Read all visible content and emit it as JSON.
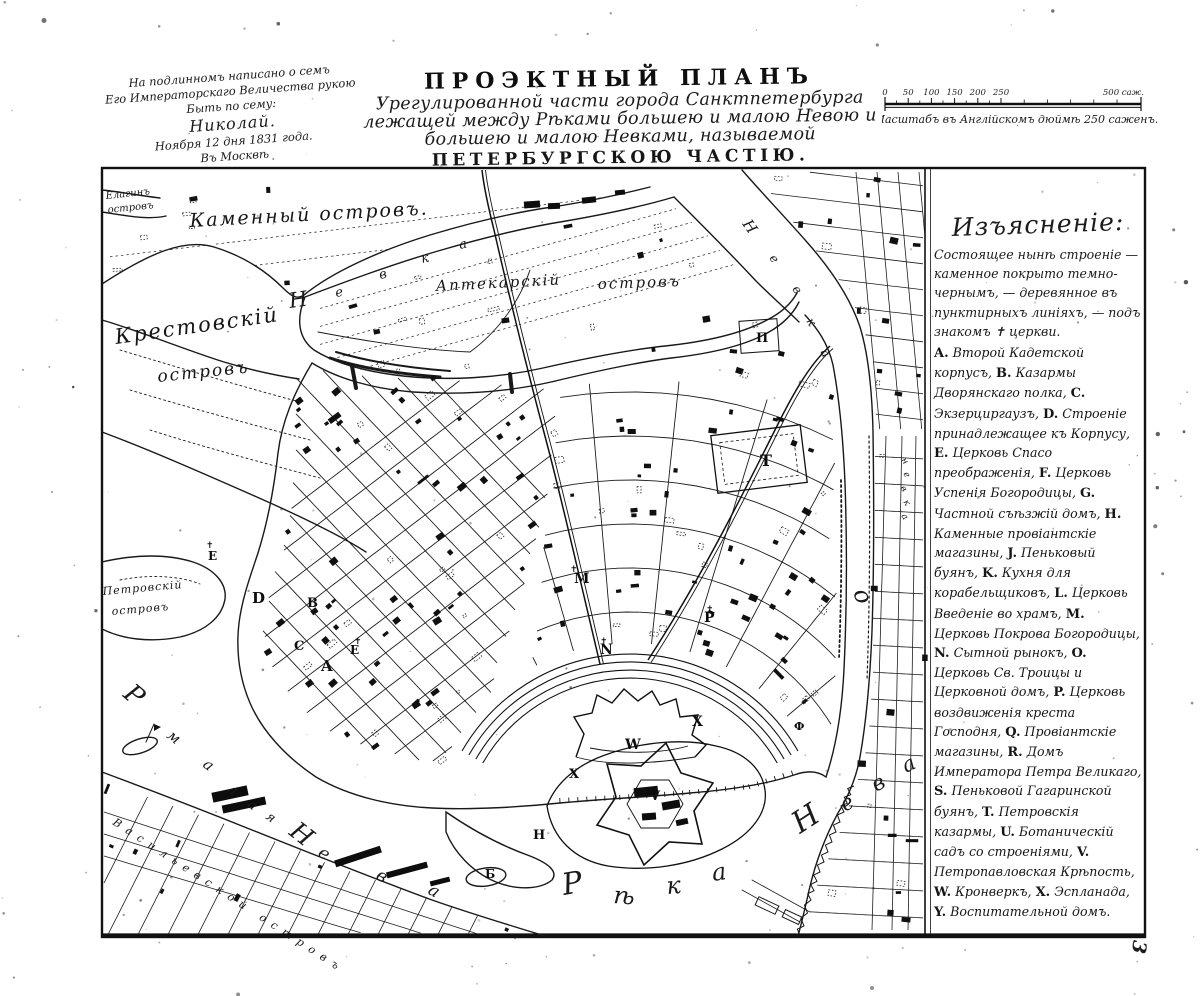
{
  "page": {
    "plate_number": "3"
  },
  "imperial_note": {
    "lines": [
      "На подлинномъ написано о семъ",
      "Его Императорскаго Величества рукою",
      "Быть по сему:",
      "Николай.",
      "Ноября 12 дня 1831 года.",
      "Въ Москвѣ"
    ]
  },
  "title": {
    "lines": [
      "ПРОЭКТНЫЙ ПЛАНЪ",
      "Урегулированной части города Санктпетербурга",
      "лежащей между Рѣками большею и малою Невою и",
      "большею и малою Невками, называемой",
      "ПЕТЕРБУРГСКОЮ ЧАСТІЮ."
    ]
  },
  "scale": {
    "tick_labels": [
      "0",
      "50",
      "100",
      "150",
      "200",
      "250"
    ],
    "end_label": "500 саж.",
    "caption": "Масштабъ въ Англійскомъ дюймѣ 250 саженъ."
  },
  "legend": {
    "header": "Изъясненіе:",
    "intro": "Состоящее нынѣ строеніе — каменное покрыто темно-чернымъ, — деревянное въ пунктирныхъ линіяхъ, — подъ знакомъ ✝ церкви.",
    "entries": [
      {
        "k": "A.",
        "t": "Второй Кадетской корпусъ,"
      },
      {
        "k": "B.",
        "t": "Казармы Дворянскаго полка,"
      },
      {
        "k": "C.",
        "t": "Экзерциргаузъ,"
      },
      {
        "k": "D.",
        "t": "Строеніе принадлежащее къ Корпусу,"
      },
      {
        "k": "E.",
        "t": "Церковь Спасо преображенія,"
      },
      {
        "k": "F.",
        "t": "Церковь Успенія Богородицы,"
      },
      {
        "k": "G.",
        "t": "Частной съѣзжій домъ,"
      },
      {
        "k": "H.",
        "t": "Каменные провіантскіе магазины,"
      },
      {
        "k": "J.",
        "t": "Пеньковый буянъ,"
      },
      {
        "k": "K.",
        "t": "Кухня для корабельщиковъ,"
      },
      {
        "k": "L.",
        "t": "Церковь Введеніе во храмъ,"
      },
      {
        "k": "M.",
        "t": "Церковь Покрова Богородицы,"
      },
      {
        "k": "N.",
        "t": "Сытной рынокъ,"
      },
      {
        "k": "O.",
        "t": "Церковь Св. Троицы и Церковной домъ,"
      },
      {
        "k": "P.",
        "t": "Церковь воздвиженія креста Господня,"
      },
      {
        "k": "Q.",
        "t": "Провіантскіе магазины,"
      },
      {
        "k": "R.",
        "t": "Домъ Императора Петра Великаго,"
      },
      {
        "k": "S.",
        "t": "Пеньковой Гагаринской буянъ,"
      },
      {
        "k": "T.",
        "t": "Петровскія казармы,"
      },
      {
        "k": "U.",
        "t": "Ботаническій садъ со строеніями,"
      },
      {
        "k": "V.",
        "t": "Петропавловская Крѣпость,"
      },
      {
        "k": "W.",
        "t": "Кронверкъ,"
      },
      {
        "k": "X.",
        "t": "Эспланада,"
      },
      {
        "k": "Y.",
        "t": "Воспитательной домъ."
      }
    ]
  },
  "map": {
    "island_labels": [
      {
        "t": "Елагинъ",
        "x": 106,
        "y": 199,
        "s": 10,
        "r": -6,
        "ls": 0
      },
      {
        "t": "островъ",
        "x": 108,
        "y": 213,
        "s": 10,
        "r": -6,
        "ls": 0
      },
      {
        "t": "Каменный островъ.",
        "x": 190,
        "y": 227,
        "s": 19,
        "r": -3,
        "ls": 2
      },
      {
        "t": "Крестовскій",
        "x": 116,
        "y": 344,
        "s": 21,
        "r": -8,
        "ls": 2
      },
      {
        "t": "островъ",
        "x": 158,
        "y": 382,
        "s": 17,
        "r": -6,
        "ls": 2
      },
      {
        "t": "Аптекарскій",
        "x": 436,
        "y": 291,
        "s": 15,
        "r": -3,
        "ls": 2
      },
      {
        "t": "островъ",
        "x": 598,
        "y": 289,
        "s": 15,
        "r": -2,
        "ls": 2
      },
      {
        "t": "Петровскій",
        "x": 103,
        "y": 595,
        "s": 11,
        "r": -5,
        "ls": 1
      },
      {
        "t": "островъ",
        "x": 112,
        "y": 615,
        "s": 11,
        "r": -5,
        "ls": 1
      },
      {
        "t": "Васильевской островъ",
        "x": 112,
        "y": 824,
        "s": 11,
        "r": 33,
        "ls": 7
      }
    ],
    "river_letters": [
      {
        "t": "Н",
        "x": 800,
        "y": 834,
        "s": 30,
        "r": -33
      },
      {
        "t": "е",
        "x": 845,
        "y": 812,
        "s": 21,
        "r": -30
      },
      {
        "t": "в",
        "x": 876,
        "y": 792,
        "s": 21,
        "r": -28
      },
      {
        "t": "а",
        "x": 906,
        "y": 773,
        "s": 21,
        "r": -26
      },
      {
        "t": "Р",
        "x": 564,
        "y": 895,
        "s": 30,
        "r": -10
      },
      {
        "t": "ѣ",
        "x": 613,
        "y": 903,
        "s": 24,
        "r": 4
      },
      {
        "t": "к",
        "x": 667,
        "y": 894,
        "s": 24,
        "r": -4
      },
      {
        "t": "а",
        "x": 713,
        "y": 881,
        "s": 24,
        "r": -8
      },
      {
        "t": "Р",
        "x": 122,
        "y": 696,
        "s": 26,
        "r": 40
      },
      {
        "t": "м",
        "x": 166,
        "y": 737,
        "s": 15,
        "r": 38
      },
      {
        "t": "а",
        "x": 202,
        "y": 766,
        "s": 15,
        "r": 38
      },
      {
        "t": "л",
        "x": 226,
        "y": 790,
        "s": 15,
        "r": 40
      },
      {
        "t": "а",
        "x": 247,
        "y": 806,
        "s": 13,
        "r": 38
      },
      {
        "t": "я",
        "x": 265,
        "y": 818,
        "s": 13,
        "r": 36
      },
      {
        "t": "Н",
        "x": 288,
        "y": 834,
        "s": 25,
        "r": 38
      },
      {
        "t": "е",
        "x": 317,
        "y": 855,
        "s": 17,
        "r": 35
      },
      {
        "t": "в",
        "x": 375,
        "y": 878,
        "s": 17,
        "r": 32
      },
      {
        "t": "а",
        "x": 427,
        "y": 893,
        "s": 17,
        "r": 30
      },
      {
        "t": "Н",
        "x": 290,
        "y": 308,
        "s": 21,
        "r": -8
      },
      {
        "t": "е",
        "x": 336,
        "y": 297,
        "s": 13,
        "r": -10
      },
      {
        "t": "в",
        "x": 380,
        "y": 279,
        "s": 13,
        "r": -12
      },
      {
        "t": "к",
        "x": 422,
        "y": 263,
        "s": 13,
        "r": -12
      },
      {
        "t": "а",
        "x": 460,
        "y": 249,
        "s": 13,
        "r": -12
      },
      {
        "t": "Н",
        "x": 742,
        "y": 224,
        "s": 15,
        "r": 55
      },
      {
        "t": "е",
        "x": 769,
        "y": 258,
        "s": 12,
        "r": 55
      },
      {
        "t": "в",
        "x": 792,
        "y": 289,
        "s": 12,
        "r": 55
      },
      {
        "t": "к",
        "x": 806,
        "y": 321,
        "s": 12,
        "r": 58
      },
      {
        "t": "а",
        "x": 820,
        "y": 352,
        "s": 12,
        "r": 60
      },
      {
        "t": "н",
        "x": 901,
        "y": 460,
        "s": 9,
        "r": 55
      },
      {
        "t": "е",
        "x": 903,
        "y": 474,
        "s": 9,
        "r": 55
      },
      {
        "t": "в",
        "x": 900,
        "y": 488,
        "s": 9,
        "r": 55
      },
      {
        "t": "к",
        "x": 903,
        "y": 502,
        "s": 9,
        "r": 55
      },
      {
        "t": "а",
        "x": 901,
        "y": 516,
        "s": 9,
        "r": 55
      },
      {
        "t": "о",
        "x": 853,
        "y": 592,
        "s": 24,
        "r": 70
      }
    ],
    "ref_letters": [
      {
        "t": "A",
        "x": 321,
        "y": 671,
        "s": 15
      },
      {
        "t": "B",
        "x": 307,
        "y": 607,
        "s": 13
      },
      {
        "t": "C",
        "x": 294,
        "y": 650,
        "s": 13
      },
      {
        "t": "D",
        "x": 252,
        "y": 603,
        "s": 15
      },
      {
        "t": "E",
        "x": 208,
        "y": 560,
        "s": 12
      },
      {
        "t": "Е",
        "x": 350,
        "y": 654,
        "s": 12
      },
      {
        "t": "М",
        "x": 574,
        "y": 583,
        "s": 14
      },
      {
        "t": "N",
        "x": 600,
        "y": 654,
        "s": 14
      },
      {
        "t": "P",
        "x": 704,
        "y": 622,
        "s": 14
      },
      {
        "t": "П",
        "x": 756,
        "y": 342,
        "s": 13
      },
      {
        "t": "T",
        "x": 760,
        "y": 466,
        "s": 16
      },
      {
        "t": "V",
        "x": 650,
        "y": 800,
        "s": 13
      },
      {
        "t": "W",
        "x": 625,
        "y": 749,
        "s": 14
      },
      {
        "t": "X",
        "x": 692,
        "y": 726,
        "s": 14
      },
      {
        "t": "X",
        "x": 569,
        "y": 778,
        "s": 13
      },
      {
        "t": "Б",
        "x": 485,
        "y": 878,
        "s": 12
      },
      {
        "t": "Н",
        "x": 533,
        "y": 839,
        "s": 13
      },
      {
        "t": "Ф",
        "x": 794,
        "y": 730,
        "s": 11
      }
    ]
  }
}
